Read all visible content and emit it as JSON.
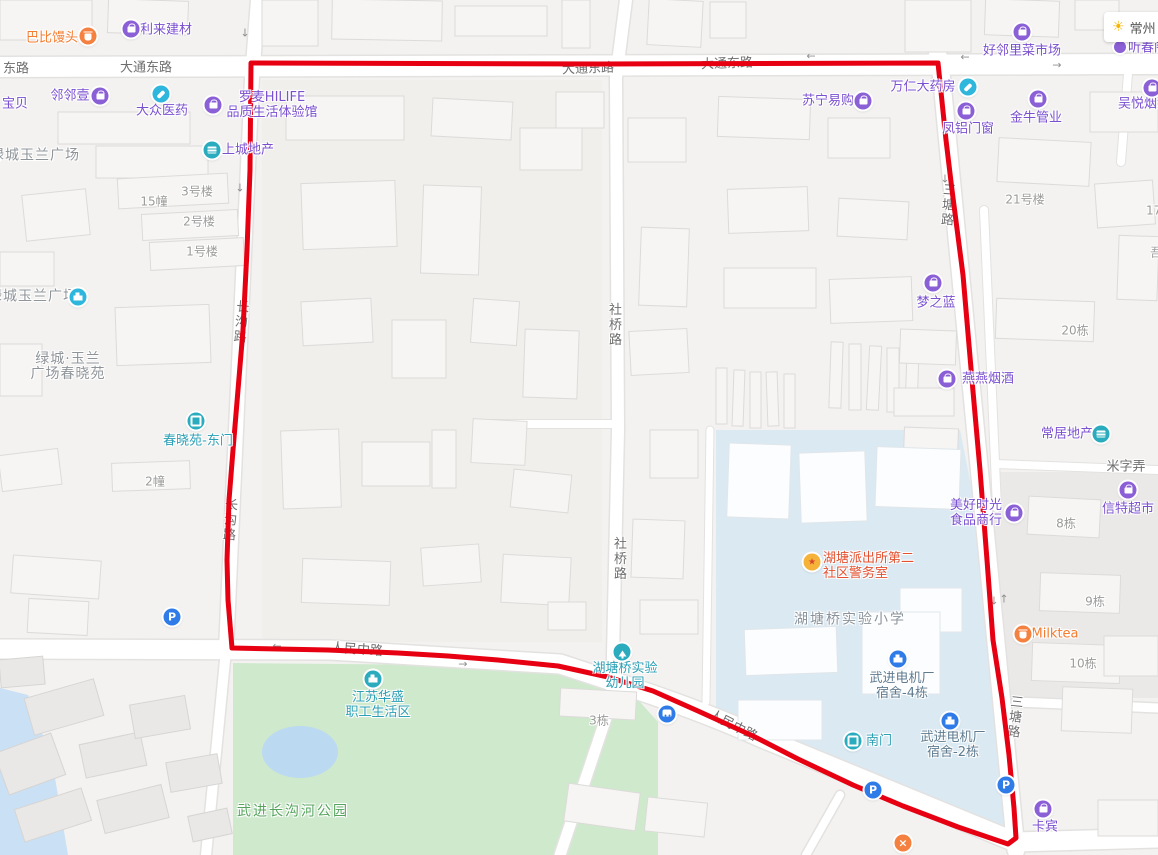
{
  "weather": {
    "city": "常州",
    "icon": "sun-icon"
  },
  "route": {
    "color": "#e60012",
    "points": "251,63 600,64 938,63 946,140 952,190 963,275 972,380 980,470 987,560 993,640 1002,698 1009,755 1014,808 1016,838 1008,844 958,827 903,806 853,785 798,759 753,736 698,711 653,691 608,677 558,666 498,660 448,656 398,653 328,650 232,648 228,600 227,560 229,500 233,450 238,390 243,330 247,250 250,170 251,63"
  },
  "road_labels": [
    {
      "t": "东路",
      "x": 16,
      "y": 69
    },
    {
      "t": "大通东路",
      "x": 146,
      "y": 68
    },
    {
      "t": "大通东路",
      "x": 588,
      "y": 69,
      "rot": -2
    },
    {
      "t": "大通东路",
      "x": 727,
      "y": 64,
      "rot": -2
    },
    {
      "t": "人民中路",
      "x": 357,
      "y": 650,
      "rot": 4
    },
    {
      "t": "人民中路",
      "x": 733,
      "y": 726,
      "rot": 27
    },
    {
      "t": "社桥路",
      "x": 613,
      "y": 325,
      "v": 1
    },
    {
      "t": "社桥路",
      "x": 618,
      "y": 559,
      "v": 1
    },
    {
      "t": "长沟路",
      "x": 239,
      "y": 322,
      "v": 1,
      "rot": 5
    },
    {
      "t": "长沟路",
      "x": 228,
      "y": 520,
      "v": 1,
      "rot": 4
    },
    {
      "t": "三塘路",
      "x": 946,
      "y": 205,
      "v": 1,
      "rot": 4
    },
    {
      "t": "三塘路",
      "x": 1013,
      "y": 717,
      "v": 1,
      "rot": 6
    },
    {
      "t": "米字弄",
      "x": 1126,
      "y": 467
    }
  ],
  "unit_labels": [
    {
      "t": "15幢",
      "x": 154,
      "y": 202
    },
    {
      "t": "3号楼",
      "x": 197,
      "y": 192
    },
    {
      "t": "2号楼",
      "x": 199,
      "y": 222
    },
    {
      "t": "1号楼",
      "x": 202,
      "y": 252
    },
    {
      "t": "2幢",
      "x": 155,
      "y": 482
    },
    {
      "t": "3栋",
      "x": 599,
      "y": 721
    },
    {
      "t": "20栋",
      "x": 1075,
      "y": 331
    },
    {
      "t": "21号楼",
      "x": 1025,
      "y": 200
    },
    {
      "t": "8栋",
      "x": 1066,
      "y": 524
    },
    {
      "t": "9栋",
      "x": 1095,
      "y": 602
    },
    {
      "t": "10栋",
      "x": 1083,
      "y": 664
    },
    {
      "t": "17栋",
      "x": 1146,
      "y": 211,
      "align": "left"
    },
    {
      "t": "吾",
      "x": 1150,
      "y": 253,
      "align": "left"
    }
  ],
  "area_labels": [
    {
      "t": "绿城玉兰广场",
      "x": -10,
      "y": 156,
      "cls": "gray-lg",
      "align": "left"
    },
    {
      "t": "绿城玉兰广场",
      "x": -12,
      "y": 297,
      "cls": "gray-lg",
      "align": "left",
      "icon": {
        "g": "building",
        "c": "cyan",
        "x": 78,
        "y": 297
      }
    },
    {
      "lines": [
        "绿城·玉兰",
        "广场春晓苑"
      ],
      "x": 68,
      "y": 367,
      "cls": "gray-lg"
    },
    {
      "t": "湖塘桥实验小学",
      "x": 850,
      "y": 620,
      "cls": "slate-lg"
    },
    {
      "t": "武进长沟河公园",
      "x": 293,
      "y": 812,
      "cls": "green"
    }
  ],
  "pois": [
    {
      "t": "巴比馒头",
      "x": 52,
      "y": 38,
      "cls": "orange",
      "icon": {
        "g": "cup",
        "c": "orange",
        "x": 88,
        "y": 36
      }
    },
    {
      "t": "利来建材",
      "x": 166,
      "y": 30,
      "cls": "purple",
      "icon": {
        "g": "bag",
        "c": "purple",
        "x": 131,
        "y": 29
      }
    },
    {
      "t": "宝贝",
      "x": 2,
      "y": 104,
      "cls": "purple",
      "align": "left"
    },
    {
      "t": "邻邻壹",
      "x": 70,
      "y": 96,
      "cls": "purple",
      "icon": {
        "g": "bag",
        "c": "purple",
        "x": 100,
        "y": 96
      }
    },
    {
      "t": "大众医药",
      "x": 162,
      "y": 111,
      "cls": "purple",
      "icon": {
        "g": "pill",
        "c": "cyan",
        "x": 161,
        "y": 94
      }
    },
    {
      "lines": [
        "罗麦HILIFE",
        "品质生活体验馆"
      ],
      "x": 272,
      "y": 105,
      "cls": "purple",
      "icon": {
        "g": "bag",
        "c": "purple",
        "x": 213,
        "y": 105
      }
    },
    {
      "t": "上城地产",
      "x": 248,
      "y": 150,
      "cls": "purple",
      "icon": {
        "g": "lines",
        "c": "teal",
        "x": 212,
        "y": 150
      }
    },
    {
      "t": "苏宁易购",
      "x": 828,
      "y": 101,
      "cls": "purple",
      "icon": {
        "g": "bag",
        "c": "purple",
        "x": 863,
        "y": 101
      }
    },
    {
      "t": "万仁大药房",
      "x": 923,
      "y": 87,
      "cls": "purple",
      "icon": {
        "g": "pill",
        "c": "cyan",
        "x": 968,
        "y": 87
      }
    },
    {
      "t": "好邻里菜市场",
      "x": 1022,
      "y": 51,
      "cls": "purple",
      "icon": {
        "g": "bag",
        "c": "purple",
        "x": 1022,
        "y": 32
      }
    },
    {
      "t": "凤铝门窗",
      "x": 968,
      "y": 129,
      "cls": "purple",
      "icon": {
        "g": "bag",
        "c": "purple",
        "x": 966,
        "y": 111
      }
    },
    {
      "t": "金牛管业",
      "x": 1036,
      "y": 118,
      "cls": "purple",
      "icon": {
        "g": "bag",
        "c": "purple",
        "x": 1038,
        "y": 99
      }
    },
    {
      "t": "吴悦烟酒",
      "x": 1118,
      "y": 104,
      "cls": "purple",
      "align": "left",
      "icon": {
        "g": "bag",
        "c": "purple",
        "x": 1152,
        "y": 88
      }
    },
    {
      "t": "听春阁",
      "x": 1128,
      "y": 48,
      "cls": "purple",
      "align": "left",
      "icon": {
        "g": "mini",
        "c": "purple",
        "x": 1120,
        "y": 47
      }
    },
    {
      "t": "梦之蓝",
      "x": 936,
      "y": 303,
      "cls": "purple",
      "icon": {
        "g": "bag",
        "c": "purple",
        "x": 933,
        "y": 283
      }
    },
    {
      "t": "燕燕烟酒",
      "x": 988,
      "y": 379,
      "cls": "purple",
      "icon": {
        "g": "bag",
        "c": "purple",
        "x": 947,
        "y": 379
      }
    },
    {
      "t": "常居地产",
      "x": 1067,
      "y": 434,
      "cls": "purple",
      "icon": {
        "g": "lines",
        "c": "teal",
        "x": 1101,
        "y": 434
      }
    },
    {
      "lines": [
        "美好时光",
        "食品商行"
      ],
      "x": 976,
      "y": 513,
      "cls": "purple",
      "icon": {
        "g": "bag",
        "c": "purple",
        "x": 1014,
        "y": 513
      }
    },
    {
      "t": "信特超市",
      "x": 1128,
      "y": 509,
      "cls": "purple",
      "icon": {
        "g": "bag",
        "c": "purple",
        "x": 1128,
        "y": 490
      }
    },
    {
      "t": "Milktea",
      "x": 1055,
      "y": 634,
      "cls": "orange",
      "icon": {
        "g": "cup",
        "c": "orange",
        "x": 1023,
        "y": 634
      }
    },
    {
      "t": "卡宾",
      "x": 1045,
      "y": 827,
      "cls": "purple",
      "icon": {
        "g": "bag",
        "c": "purple",
        "x": 1043,
        "y": 809
      }
    },
    {
      "t": "春晓苑-东门",
      "x": 198,
      "y": 441,
      "cls": "teal",
      "icon": {
        "g": "gate",
        "c": "teal",
        "x": 196,
        "y": 421
      }
    },
    {
      "t": "南门",
      "x": 879,
      "y": 741,
      "cls": "teal",
      "icon": {
        "g": "gate",
        "c": "teal",
        "x": 853,
        "y": 741
      }
    },
    {
      "lines": [
        "湖塘桥实验",
        "幼儿园"
      ],
      "x": 625,
      "y": 676,
      "cls": "teal",
      "icon": {
        "g": "tree",
        "c": "teal",
        "x": 622,
        "y": 652
      }
    },
    {
      "lines": [
        "江苏华盛",
        "职工生活区"
      ],
      "x": 378,
      "y": 705,
      "cls": "teal",
      "icon": {
        "g": "building",
        "c": "teal",
        "x": 373,
        "y": 679
      }
    },
    {
      "lines": [
        "武进电机厂",
        "宿舍-4栋"
      ],
      "x": 902,
      "y": 686,
      "cls": "slate",
      "icon": {
        "g": "building",
        "c": "blue",
        "x": 898,
        "y": 659
      }
    },
    {
      "lines": [
        "武进电机厂",
        "宿舍-2栋"
      ],
      "x": 953,
      "y": 745,
      "cls": "slate",
      "icon": {
        "g": "building",
        "c": "blue",
        "x": 950,
        "y": 721
      }
    },
    {
      "lines": [
        "湖塘派出所第二",
        "社区警务室"
      ],
      "x": 823,
      "y": 566,
      "cls": "red",
      "align": "left",
      "icon": {
        "g": "badge",
        "c": "gold",
        "x": 812,
        "y": 562
      }
    }
  ],
  "service_icons": [
    {
      "g": "p",
      "c": "blue",
      "x": 172,
      "y": 617,
      "name": "parking-icon"
    },
    {
      "g": "p",
      "c": "blue",
      "x": 873,
      "y": 790,
      "name": "parking-icon"
    },
    {
      "g": "p",
      "c": "blue",
      "x": 1006,
      "y": 785,
      "name": "parking-icon"
    },
    {
      "g": "bus",
      "c": "blue",
      "x": 667,
      "y": 714,
      "name": "bus-stop-icon"
    },
    {
      "g": "x",
      "c": "orange",
      "x": 903,
      "y": 843,
      "name": "restaurant-icon"
    }
  ],
  "arrows": [
    {
      "g": "↓",
      "x": 245,
      "y": 33
    },
    {
      "g": "↓",
      "x": 240,
      "y": 188
    },
    {
      "g": "←",
      "x": 811,
      "y": 56
    },
    {
      "g": "←",
      "x": 965,
      "y": 57
    },
    {
      "g": "→",
      "x": 1057,
      "y": 65
    },
    {
      "g": "↓",
      "x": 945,
      "y": 179
    },
    {
      "g": "↓",
      "x": 994,
      "y": 601
    },
    {
      "g": "↑",
      "x": 1004,
      "y": 599
    },
    {
      "g": "→",
      "x": 463,
      "y": 664
    },
    {
      "g": "←",
      "x": 277,
      "y": 646
    }
  ]
}
